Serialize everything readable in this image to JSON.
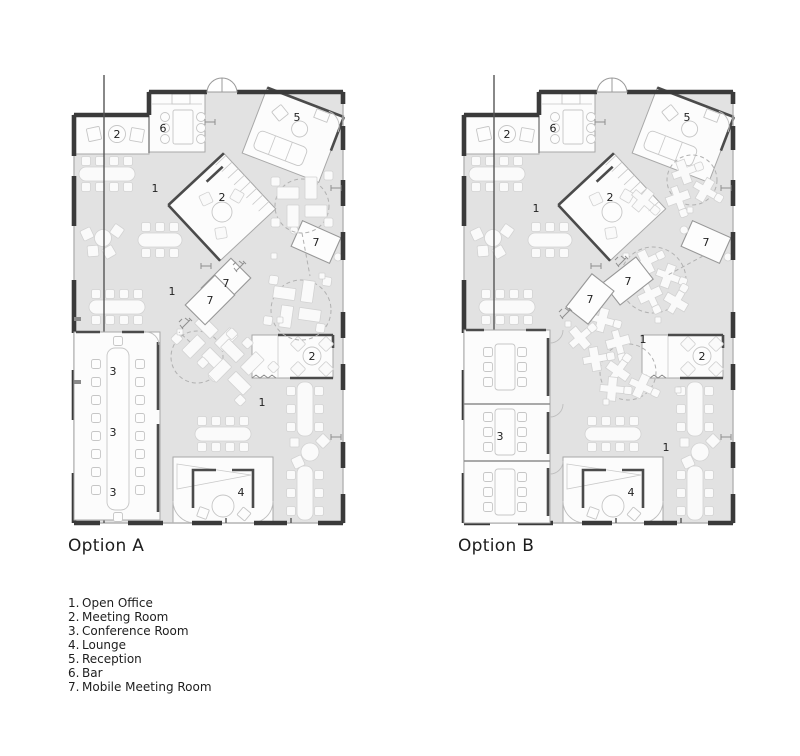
{
  "colors": {
    "background": "#ffffff",
    "floor": "#e2e2e2",
    "walls": "#3a3a3a",
    "room_fill": "#fcfcfc",
    "furniture_stroke": "#c9c9c9",
    "text": "#1e1e1e"
  },
  "plans": [
    {
      "title": "Option A",
      "labels": {
        "meeting_tl": "2",
        "bar": "6",
        "reception": "5",
        "open_upper": "1",
        "meeting_center": "2",
        "mobile_right": "7",
        "mobile_a": "7",
        "mobile_b": "7",
        "open_mid": "1",
        "meeting_right": "2",
        "conf_top": "3",
        "conf_mid": "3",
        "conf_bottom": "3",
        "open_lower": "1",
        "lounge": "4"
      }
    },
    {
      "title": "Option B",
      "labels": {
        "meeting_tl": "2",
        "bar": "6",
        "reception": "5",
        "open_upper": "1",
        "meeting_center": "2",
        "mobile_right": "7",
        "mobile_a": "7",
        "mobile_b": "7",
        "open_mid": "1",
        "meeting_right": "2",
        "conf": "3",
        "open_lower": "1",
        "lounge": "4"
      }
    }
  ],
  "legend": {
    "items": [
      {
        "number": "1.",
        "label": "Open Office"
      },
      {
        "number": "2.",
        "label": "Meeting Room"
      },
      {
        "number": "3.",
        "label": "Conference Room"
      },
      {
        "number": "4.",
        "label": "Lounge"
      },
      {
        "number": "5.",
        "label": "Reception"
      },
      {
        "number": "6.",
        "label": "Bar"
      },
      {
        "number": "7.",
        "label": "Mobile Meeting Room"
      }
    ]
  }
}
